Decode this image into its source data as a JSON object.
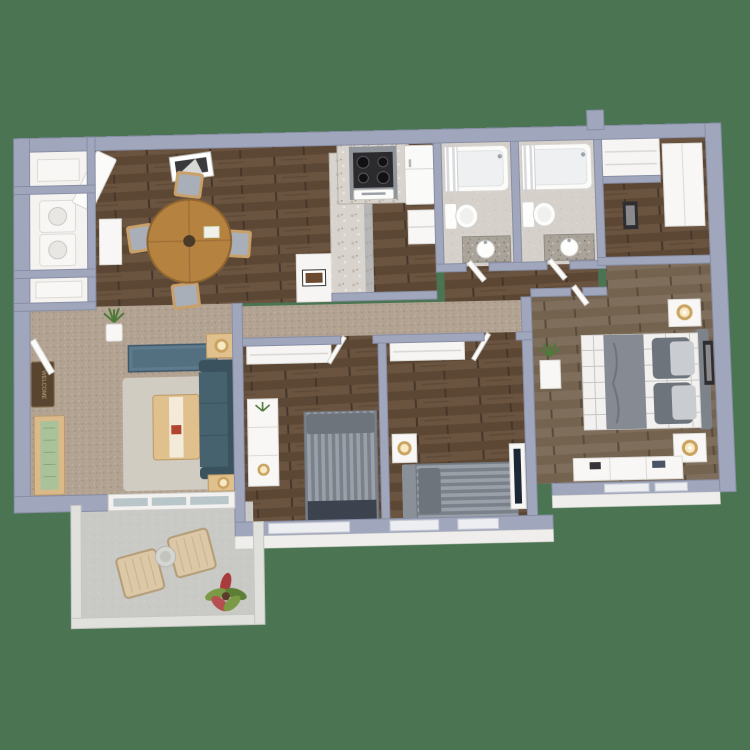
{
  "scene": {
    "description": "3D-rendered top-down floor plan of an apartment on a green background",
    "doormat_label": "WELCOME"
  },
  "colors": {
    "bg": "#4a7452",
    "wall": "#a0a6bc",
    "wallEdge": "#878da4",
    "whiteFace": "#efeeec",
    "woodBase": "#5c4734",
    "woodLight": "#6a5440",
    "woodJoint": "#46362a",
    "woodmBase": "#73634f",
    "woodmLight": "#7e6e5b",
    "woodmJoint": "#5a4c3c",
    "carpetBase": "#b2a292",
    "tileBase": "#d5d0c9",
    "concreteBase": "#c9c9c5",
    "marbleBase": "#d8d3cc",
    "graniteBase": "#a9a39a",
    "sofa": "#47626f",
    "sofaDark": "#39525e",
    "console": "#5d7b8d",
    "rug": "#d4cfc7",
    "tableWood": "#b5823f",
    "lightWood": "#e0c08c",
    "bedStripeA": "#7b818a",
    "bedStripeB": "#9aa0a8",
    "bedDark": "#3c424e",
    "pillowGray": "#6e747c",
    "duvetWhite": "#f2f1ef",
    "throwGray": "#868b93",
    "lampGlow": "#f7e9c4",
    "lampRing": "#c9a35f",
    "plantGreen": "#4e7a3a",
    "plantRed": "#a83c3c",
    "glass": "#b9c6c9",
    "matBrown": "#59452f",
    "rattan": "#dcc8a6"
  },
  "rooms": [
    {
      "id": "dining-room",
      "floor": "dark-wood"
    },
    {
      "id": "kitchen",
      "floor": "dark-wood"
    },
    {
      "id": "bathroom-1",
      "floor": "tile"
    },
    {
      "id": "bathroom-2",
      "floor": "tile"
    },
    {
      "id": "hall-closet-area",
      "floor": "dark-wood"
    },
    {
      "id": "master-bedroom",
      "floor": "gray-wood"
    },
    {
      "id": "bedroom-2",
      "floor": "dark-wood"
    },
    {
      "id": "bedroom-3",
      "floor": "dark-wood"
    },
    {
      "id": "living-room",
      "floor": "carpet"
    },
    {
      "id": "hallway",
      "floor": "carpet"
    },
    {
      "id": "laundry-closets",
      "floor": "white"
    },
    {
      "id": "patio",
      "floor": "concrete"
    }
  ],
  "furniture": {
    "dining-room": [
      "round-dining-table",
      "dining-chairs-x4",
      "wall-art",
      "sideboard",
      "open-door"
    ],
    "kitchen": [
      "range-with-hood",
      "oven",
      "refrigerator",
      "marble-counter",
      "marble-peninsula",
      "art-niche"
    ],
    "bathroom-1": [
      "bathtub-with-curtain",
      "toilet",
      "granite-vanity-with-sink"
    ],
    "bathroom-2": [
      "bathtub-with-curtain",
      "toilet",
      "granite-vanity-with-sink"
    ],
    "hall-closet-area": [
      "coat-closet",
      "wardrobe",
      "wall-art"
    ],
    "master-bedroom": [
      "plaid-queen-bed",
      "nightstand-with-lamp-x2",
      "dresser",
      "plant-pedestal",
      "wall-art",
      "tv-on-dresser"
    ],
    "bedroom-2": [
      "striped-bed",
      "dresser-with-lamp-and-plant",
      "closet-shelf"
    ],
    "bedroom-3": [
      "striped-bed",
      "nightstand-with-lamp",
      "closet-shelf",
      "tv-on-dresser"
    ],
    "living-room": [
      "sofa",
      "coffee-table",
      "area-rug",
      "media-console",
      "side-table-with-lamp-x2",
      "entry-bench",
      "welcome-mat",
      "potted-plant"
    ],
    "laundry-closets": [
      "stacked-washer-dryer",
      "storage-shelves"
    ],
    "patio": [
      "lounge-chair-x2",
      "round-side-table",
      "potted-plant",
      "sliding-glass-door"
    ]
  }
}
